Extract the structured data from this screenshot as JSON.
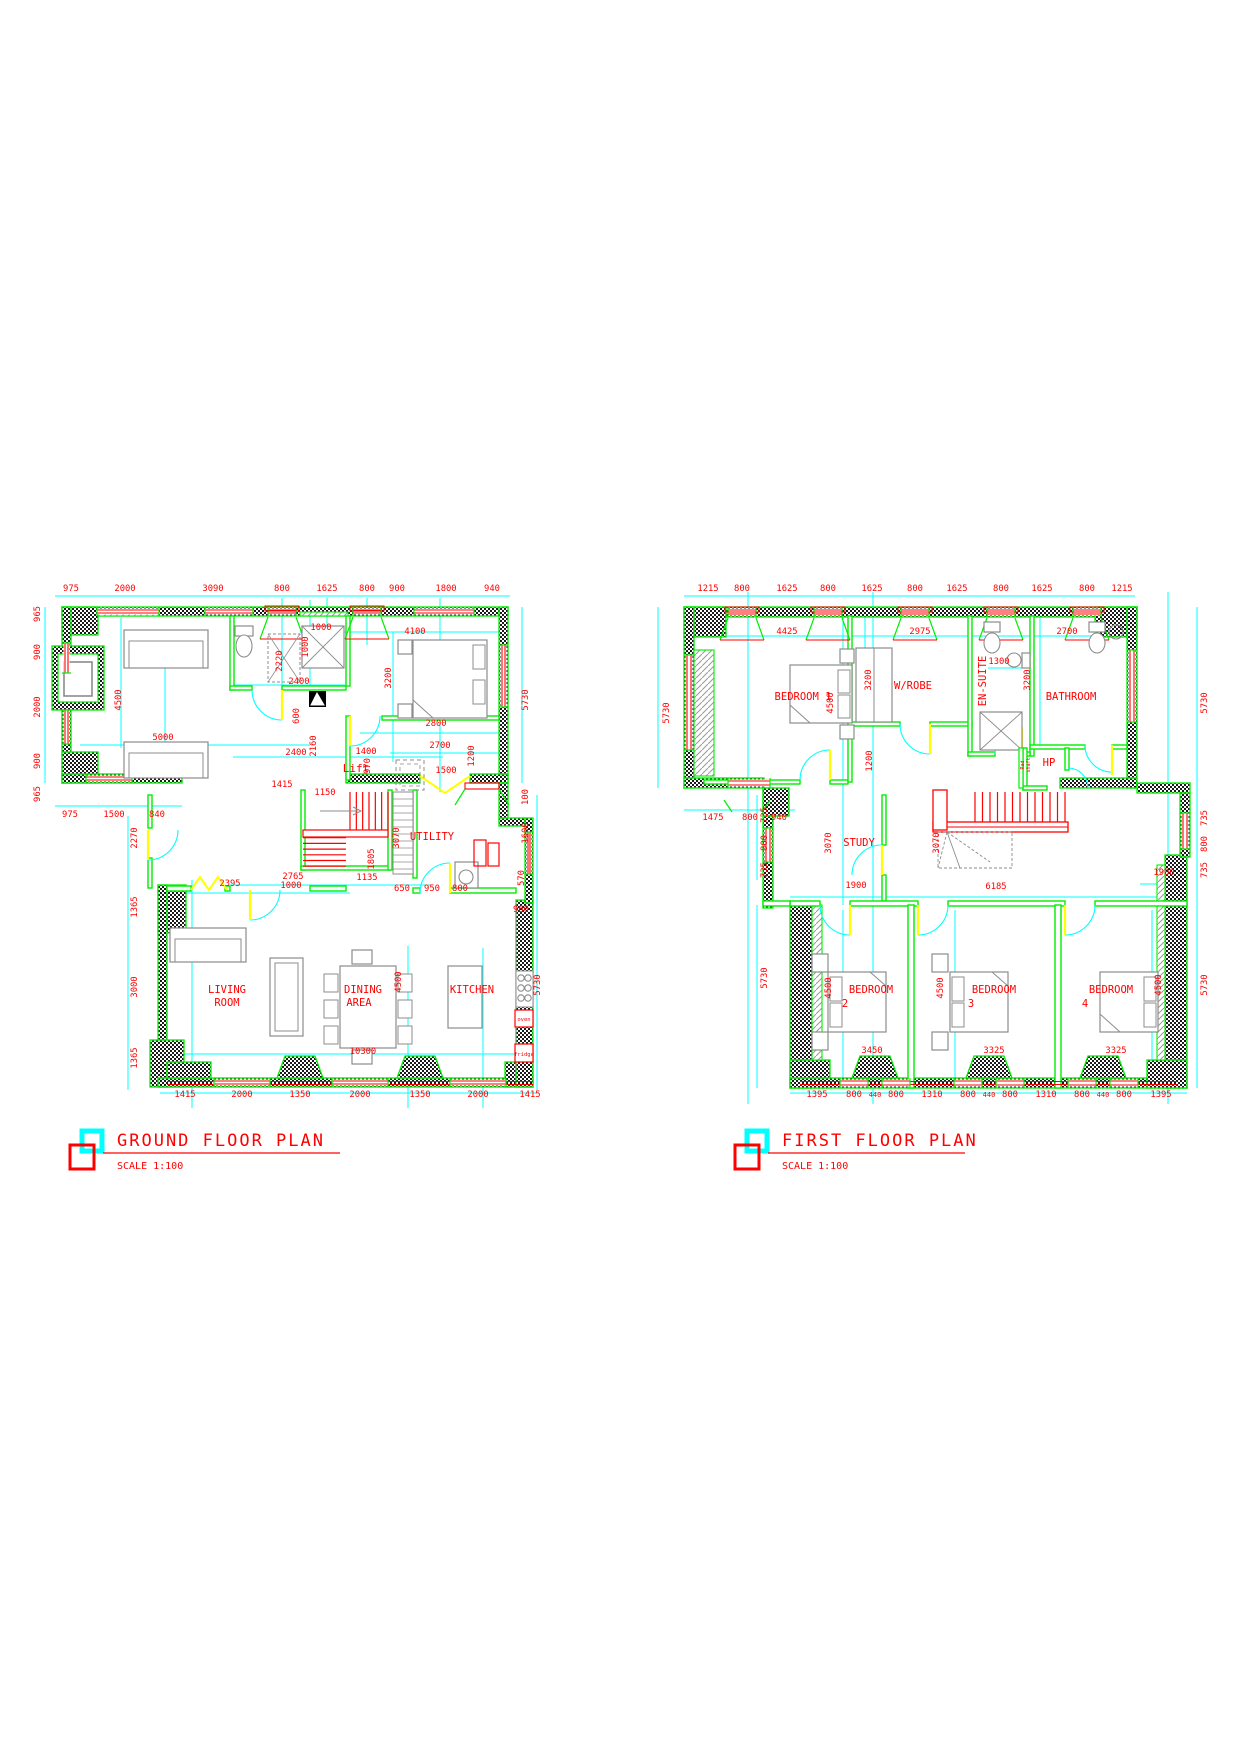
{
  "colors": {
    "wall": "#00ee00",
    "dimension_text": "#ff0000",
    "dimension_line": "#00ffff",
    "door": "#ffff00",
    "furniture": "#8c8c8c",
    "background": "#ffffff"
  },
  "ground_floor": {
    "title": "GROUND FLOOR PLAN",
    "scale_label": "SCALE 1:100",
    "dim_labels": [
      [
        "975",
        71,
        591
      ],
      [
        "2000",
        125,
        591
      ],
      [
        "3090",
        213,
        591
      ],
      [
        "800",
        282,
        591
      ],
      [
        "1625",
        327,
        591
      ],
      [
        "800",
        367,
        591
      ],
      [
        "900",
        397,
        591
      ],
      [
        "1800",
        446,
        591
      ],
      [
        "940",
        492,
        591
      ],
      [
        "965",
        40,
        614,
        -90
      ],
      [
        "900",
        40,
        652,
        -90
      ],
      [
        "2000",
        40,
        707,
        -90
      ],
      [
        "900",
        40,
        761,
        -90
      ],
      [
        "965",
        40,
        794,
        -90
      ],
      [
        "975",
        70,
        817
      ],
      [
        "1500",
        114,
        817
      ],
      [
        "840",
        157,
        817
      ],
      [
        "2270",
        137,
        838,
        -90
      ],
      [
        "1365",
        137,
        907,
        -90
      ],
      [
        "3000",
        137,
        987,
        -90
      ],
      [
        "1365",
        137,
        1058,
        -90
      ],
      [
        "1415",
        185,
        1097
      ],
      [
        "2000",
        242,
        1097
      ],
      [
        "1350",
        300,
        1097
      ],
      [
        "2000",
        360,
        1097
      ],
      [
        "1350",
        420,
        1097
      ],
      [
        "2000",
        478,
        1097
      ],
      [
        "1415",
        530,
        1097
      ],
      [
        "5730",
        528,
        700,
        -90
      ],
      [
        "100",
        528,
        797,
        -90
      ],
      [
        "1600",
        528,
        833,
        -90
      ],
      [
        "570",
        524,
        878,
        -90
      ],
      [
        "960",
        521,
        912
      ],
      [
        "5730",
        540,
        985,
        -90
      ],
      [
        "4500",
        121,
        700,
        -90
      ],
      [
        "5000",
        163,
        740
      ],
      [
        "2220",
        282,
        661,
        -90
      ],
      [
        "2400",
        299,
        684
      ],
      [
        "1000",
        321,
        630
      ],
      [
        "1000",
        308,
        647,
        -90
      ],
      [
        "4100",
        415,
        634
      ],
      [
        "3200",
        391,
        678,
        -90
      ],
      [
        "600",
        299,
        716,
        -90
      ],
      [
        "2160",
        316,
        746,
        -90
      ],
      [
        "2400",
        296,
        755
      ],
      [
        "1400",
        366,
        754
      ],
      [
        "970",
        370,
        766,
        -90
      ],
      [
        "2800",
        436,
        726
      ],
      [
        "2700",
        440,
        748
      ],
      [
        "1200",
        474,
        756,
        -90
      ],
      [
        "1500",
        446,
        773
      ],
      [
        "1415",
        282,
        787
      ],
      [
        "1150",
        325,
        795
      ],
      [
        "3070",
        399,
        838,
        -90
      ],
      [
        "1805",
        374,
        859,
        -90
      ],
      [
        "1135",
        367,
        880
      ],
      [
        "2765",
        293,
        879
      ],
      [
        "1000",
        291,
        888
      ],
      [
        "2395",
        230,
        886
      ],
      [
        "650",
        402,
        891
      ],
      [
        "950",
        432,
        891
      ],
      [
        "800",
        460,
        891
      ],
      [
        "4500",
        401,
        982,
        -90
      ],
      [
        "10300",
        363,
        1054
      ]
    ],
    "room_labels": [
      [
        "LIVING",
        227,
        993
      ],
      [
        "ROOM",
        227,
        1006
      ],
      [
        "DINING",
        363,
        993
      ],
      [
        "AREA",
        359,
        1006
      ],
      [
        "KITCHEN",
        472,
        993
      ],
      [
        "UTILITY",
        432,
        840
      ],
      [
        "Lift",
        356,
        772,
        0,
        11
      ]
    ],
    "appliance_labels": [
      [
        "oven",
        524,
        1021
      ],
      [
        "fridge",
        524,
        1056
      ]
    ]
  },
  "first_floor": {
    "title": "FIRST FLOOR PLAN",
    "scale_label": "SCALE 1:100",
    "dim_labels": [
      [
        "1215",
        708,
        591
      ],
      [
        "800",
        742,
        591
      ],
      [
        "1625",
        787,
        591
      ],
      [
        "800",
        828,
        591
      ],
      [
        "1625",
        872,
        591
      ],
      [
        "800",
        915,
        591
      ],
      [
        "1625",
        957,
        591
      ],
      [
        "800",
        1001,
        591
      ],
      [
        "1625",
        1042,
        591
      ],
      [
        "800",
        1087,
        591
      ],
      [
        "1215",
        1122,
        591
      ],
      [
        "5730",
        669,
        713,
        -90
      ],
      [
        "1475",
        713,
        820
      ],
      [
        "800",
        750,
        820
      ],
      [
        "940",
        779,
        820
      ],
      [
        "735",
        767,
        815,
        -90
      ],
      [
        "800",
        767,
        843,
        -90
      ],
      [
        "735",
        767,
        870,
        -90
      ],
      [
        "5730",
        767,
        978,
        -90
      ],
      [
        "5730",
        1207,
        703,
        -90
      ],
      [
        "735",
        1207,
        818,
        -90
      ],
      [
        "800",
        1207,
        844,
        -90
      ],
      [
        "735",
        1207,
        870,
        -90
      ],
      [
        "5730",
        1207,
        985,
        -90
      ],
      [
        "1395",
        817,
        1097
      ],
      [
        "800",
        854,
        1097
      ],
      [
        "440",
        875,
        1097,
        0,
        7
      ],
      [
        "800",
        896,
        1097
      ],
      [
        "1310",
        932,
        1097
      ],
      [
        "800",
        968,
        1097
      ],
      [
        "440",
        989,
        1097,
        0,
        7
      ],
      [
        "800",
        1010,
        1097
      ],
      [
        "1310",
        1046,
        1097
      ],
      [
        "800",
        1082,
        1097
      ],
      [
        "440",
        1103,
        1097,
        0,
        7
      ],
      [
        "800",
        1124,
        1097
      ],
      [
        "1395",
        1161,
        1097
      ],
      [
        "4425",
        787,
        634
      ],
      [
        "2975",
        920,
        634
      ],
      [
        "2700",
        1067,
        634
      ],
      [
        "3200",
        871,
        680,
        -90
      ],
      [
        "4500",
        833,
        703,
        -90
      ],
      [
        "1300",
        999,
        664
      ],
      [
        "3200",
        1030,
        680,
        -90
      ],
      [
        "1200",
        872,
        761,
        -90
      ],
      [
        "3070",
        831,
        843,
        -90
      ],
      [
        "1900",
        856,
        888
      ],
      [
        "3070",
        939,
        843,
        -90
      ],
      [
        "6185",
        996,
        889
      ],
      [
        "1900",
        1164,
        875
      ],
      [
        "4500",
        831,
        988,
        -90
      ],
      [
        "3450",
        872,
        1053
      ],
      [
        "4500",
        943,
        988,
        -90
      ],
      [
        "3325",
        994,
        1053
      ],
      [
        "4500",
        1161,
        985,
        -90
      ],
      [
        "3325",
        1116,
        1053
      ]
    ],
    "room_labels": [
      [
        "BEDROOM 1",
        803,
        700
      ],
      [
        "W/ROBE",
        913,
        689
      ],
      [
        "EN-SUITE",
        986,
        681,
        -90
      ],
      [
        "BATHROOM",
        1071,
        700
      ],
      [
        "HP",
        1049,
        766
      ],
      [
        "STUDY",
        859,
        846
      ],
      [
        "BEDROOM",
        871,
        993
      ],
      [
        "2",
        845,
        1007
      ],
      [
        "BEDROOM",
        994,
        993
      ],
      [
        "3",
        971,
        1007
      ],
      [
        "BEDROOM",
        1111,
        993
      ],
      [
        "4",
        1085,
        1007
      ]
    ],
    "shaft_labels": [
      [
        "Rad",
        1024,
        765,
        -90
      ],
      [
        "shaft",
        1030,
        765,
        -90
      ]
    ]
  }
}
